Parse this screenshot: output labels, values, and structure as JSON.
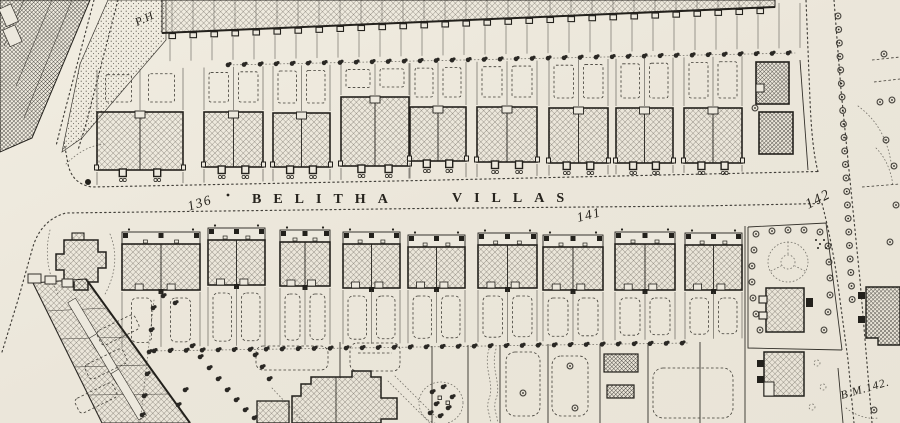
{
  "map": {
    "street": {
      "name_first_word": "BELITHA",
      "name_second_word": "VILLAS"
    },
    "house_numbers": {
      "n136": "136",
      "n141": "141",
      "n142": "142"
    },
    "annotations": {
      "public_house": "P.H",
      "benchmark": "B.M.142."
    },
    "colors": {
      "paper": "#ece8dd",
      "ink": "#23211c"
    }
  }
}
